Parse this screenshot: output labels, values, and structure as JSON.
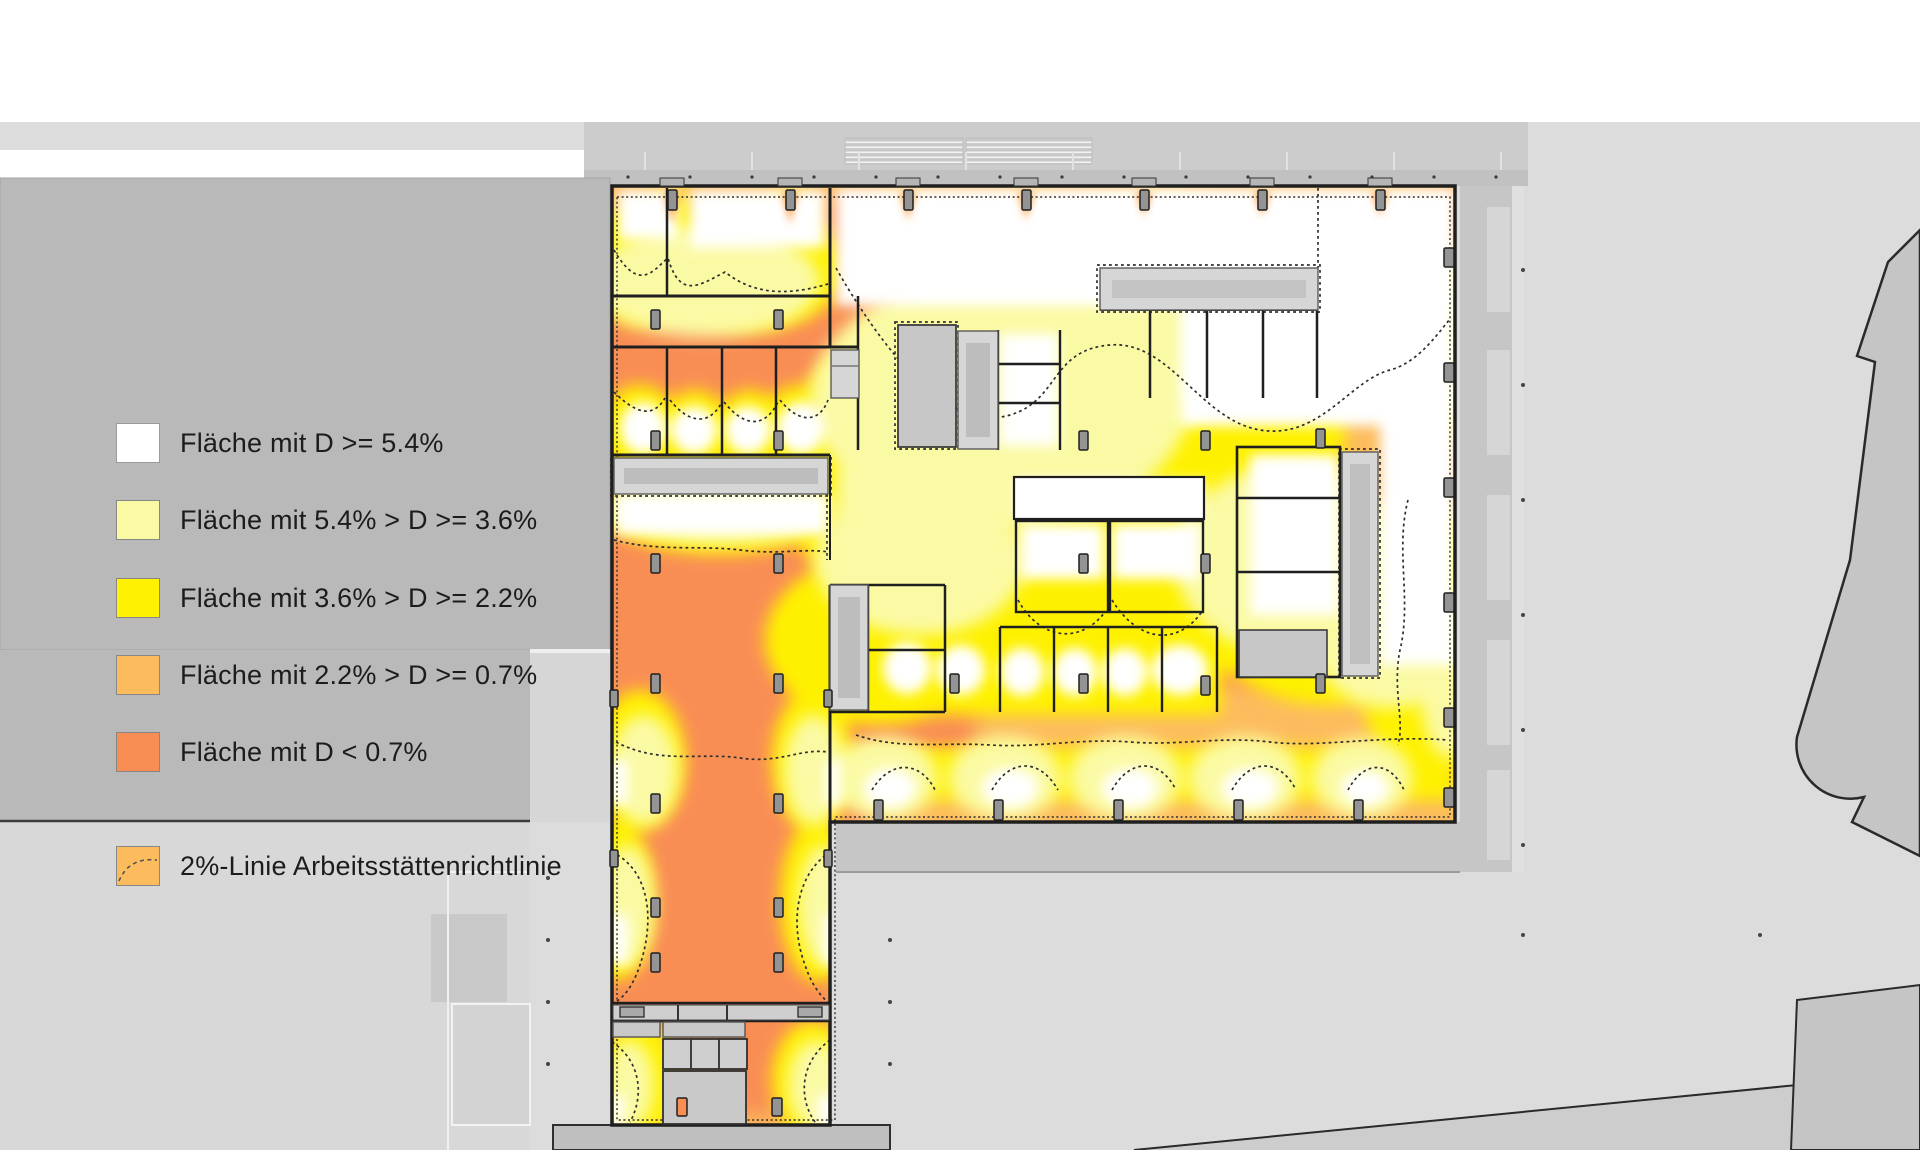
{
  "drawing": {
    "type": "daylight-factor floor plan (Tageslichtquotient-Analyse)",
    "language": "de"
  },
  "palette": {
    "dl-white": "#ffffff",
    "dl-pale": "#fbfaa4",
    "dl-yellow": "#fef102",
    "dl-mid": "#fcbc5e",
    "dl-deep": "#f98e55",
    "contour": "#2e2e2e"
  },
  "legend": {
    "items": [
      {
        "label": "Fläche mit D >= 5.4%",
        "color": "#ffffff"
      },
      {
        "label": "Fläche mit 5.4% > D >= 3.6%",
        "color": "#fbfaa4"
      },
      {
        "label": "Fläche mit 3.6% > D >= 2.2%",
        "color": "#fef102"
      },
      {
        "label": "Fläche mit 2.2% > D >= 0.7%",
        "color": "#fcbc5e"
      },
      {
        "label": "Fläche mit D < 0.7%",
        "color": "#f98e55"
      }
    ],
    "note": {
      "label": "2%-Linie Arbeitsstättenrichtlinie",
      "color": "#fcbc5e",
      "line_style": "dashed"
    }
  }
}
